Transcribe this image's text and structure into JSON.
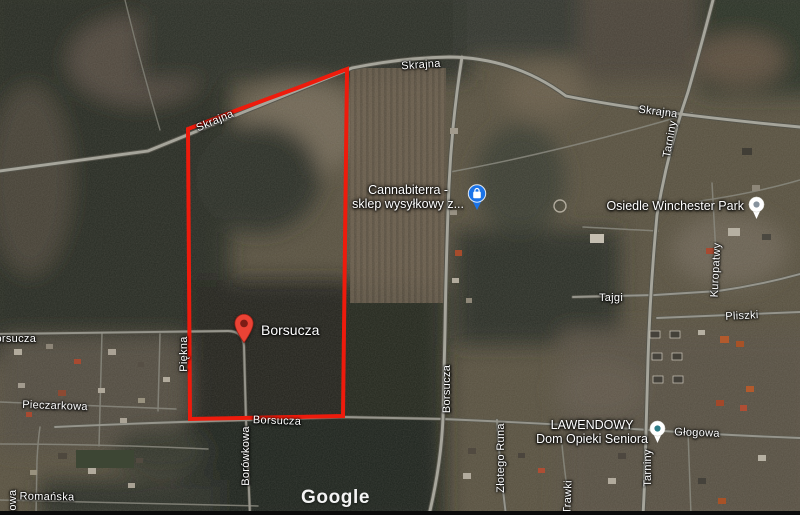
{
  "watermark": {
    "label": "Google"
  },
  "boundary": {
    "stroke_color": "#ee1b0c",
    "marker_label": "Borsucza"
  },
  "pois": [
    {
      "name": "Cannabiterra - sklep wysyłkowy z...",
      "line1": "Cannabiterra -",
      "line2": "sklep wysyłkowy z...",
      "icon": "shopping-bag-pin-icon",
      "icon_color": "#1a73e8"
    },
    {
      "name": "Osiedle Winchester Park",
      "line1": "Osiedle Winchester Park",
      "icon": "neighborhood-pin-icon",
      "icon_color": "#87939e"
    },
    {
      "name": "LAWENDOWY Dom Opieki Seniora",
      "line1": "LAWENDOWY",
      "line2": "Dom Opieki Seniora",
      "icon": "neighborhood-pin-icon",
      "icon_color": "#2e7d87"
    }
  ],
  "streets": [
    {
      "text": "Skrajna"
    },
    {
      "text": "Skrajna"
    },
    {
      "text": "Skrajna"
    },
    {
      "text": "Tarniny"
    },
    {
      "text": "Borsucza"
    },
    {
      "text": "Borsucza"
    },
    {
      "text": "Borsucza"
    },
    {
      "text": "Piękna"
    },
    {
      "text": "Borówkowa"
    },
    {
      "text": "Pieczarkowa"
    },
    {
      "text": "Romańska"
    },
    {
      "text": "kowa"
    },
    {
      "text": "Tajgi"
    },
    {
      "text": "Kuropatwy"
    },
    {
      "text": "Pliszki"
    },
    {
      "text": "Głogowa"
    },
    {
      "text": "Tarniny"
    },
    {
      "text": "Trawki"
    },
    {
      "text": "Złotego Runa"
    }
  ]
}
